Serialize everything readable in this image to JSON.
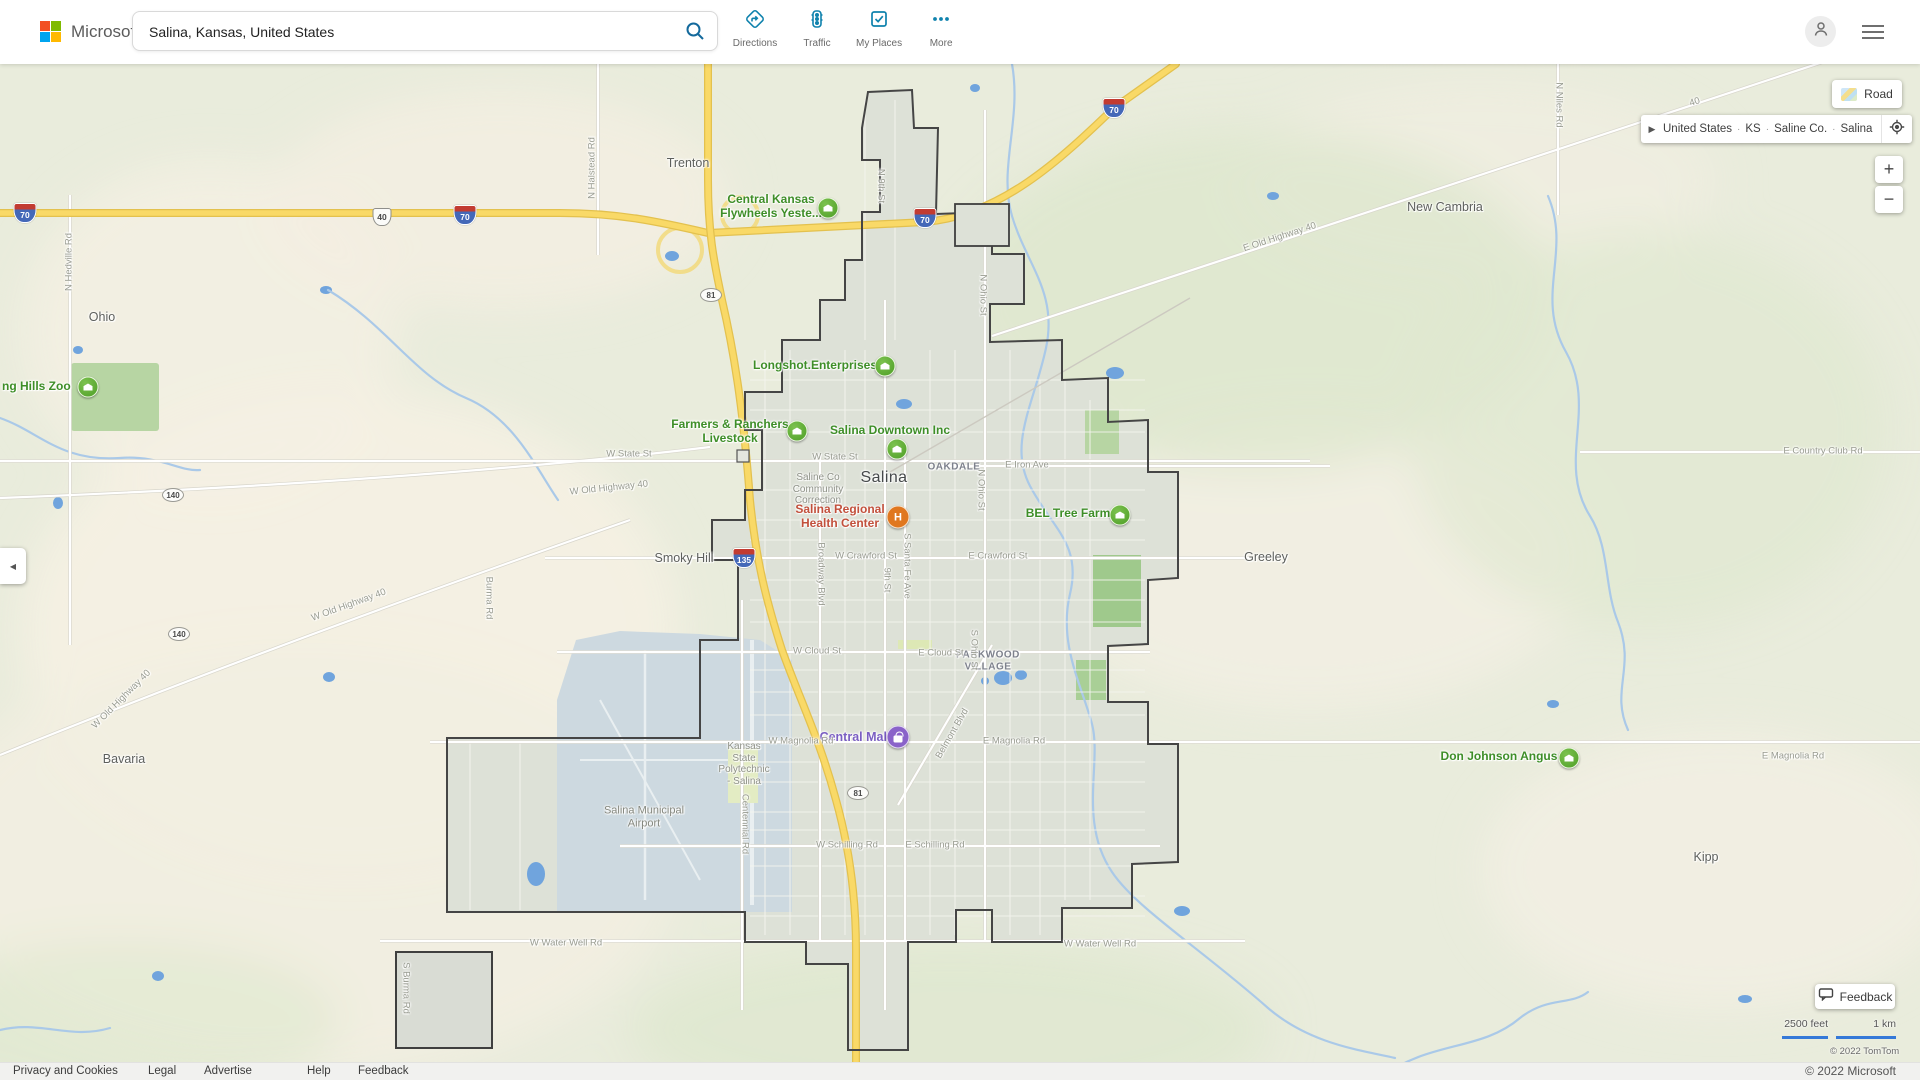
{
  "header": {
    "brand": "Microsoft Bing",
    "search": {
      "value": "Salina, Kansas, United States"
    },
    "toolbar": [
      {
        "label": "Directions",
        "icon": "directions-icon"
      },
      {
        "label": "Traffic",
        "icon": "traffic-icon"
      },
      {
        "label": "My Places",
        "icon": "my-places-icon"
      },
      {
        "label": "More",
        "icon": "more-icon"
      }
    ]
  },
  "map_controls": {
    "style_button": "Road",
    "breadcrumb": {
      "parts": [
        "United States",
        "KS",
        "Saline Co.",
        "Salina"
      ]
    },
    "zoom_in": "+",
    "zoom_out": "−",
    "feedback_button": "Feedback",
    "scale": {
      "imperial": "2500 feet",
      "metric": "1 km"
    },
    "map_copyright": "© 2022 TomTom"
  },
  "footer": {
    "links": [
      "Privacy and Cookies",
      "Legal",
      "Advertise",
      "Help",
      "Feedback"
    ],
    "copyright": "© 2022 Microsoft"
  },
  "colors": {
    "accent_teal": "#0f82ad",
    "poi_green": "#3e8e28",
    "poi_red": "#c2503c",
    "poi_purple": "#7a5ec2",
    "highway_yellow": "#f9d967",
    "water_blue": "#70a4dd"
  },
  "map": {
    "labels": [
      {
        "text": "Trenton",
        "x": 688,
        "y": 163,
        "cls": "city"
      },
      {
        "text": "Ohio",
        "x": 102,
        "y": 317,
        "cls": "city"
      },
      {
        "text": "New Cambria",
        "x": 1445,
        "y": 207,
        "cls": "city"
      },
      {
        "text": "Smoky Hill",
        "x": 684,
        "y": 558,
        "cls": "city"
      },
      {
        "text": "Greeley",
        "x": 1266,
        "y": 557,
        "cls": "city"
      },
      {
        "text": "Bavaria",
        "x": 124,
        "y": 759,
        "cls": "city"
      },
      {
        "text": "Kipp",
        "x": 1706,
        "y": 857,
        "cls": "city"
      },
      {
        "text": "Salina",
        "x": 884,
        "y": 478,
        "cls": "city-major"
      },
      {
        "text": "OAKDALE",
        "x": 954,
        "y": 467,
        "cls": "nbhd"
      },
      {
        "text": "PARKWOOD\nVILLAGE",
        "x": 988,
        "y": 661,
        "cls": "nbhd"
      },
      {
        "text": "Saline Co\nCommunity\nCorrection",
        "x": 818,
        "y": 489,
        "cls": "small"
      },
      {
        "text": "Kansas\nState\nPolytechnic\n- Salina",
        "x": 744,
        "y": 764,
        "cls": "small"
      },
      {
        "text": "Salina Municipal\nAirport",
        "x": 644,
        "y": 817,
        "cls": "area"
      },
      {
        "text": "Central Kansas\nFlywheels Yeste...",
        "x": 771,
        "y": 207,
        "cls": "poi-green"
      },
      {
        "text": "Longshot.Enterprises",
        "x": 815,
        "y": 366,
        "cls": "poi-green"
      },
      {
        "text": "Farmers & Ranchers\nLivestock",
        "x": 730,
        "y": 432,
        "cls": "poi-green"
      },
      {
        "text": "Salina Downtown Inc",
        "x": 890,
        "y": 431,
        "cls": "poi-green"
      },
      {
        "text": "BEL Tree Farm",
        "x": 1068,
        "y": 514,
        "cls": "poi-green"
      },
      {
        "text": "Don Johnson Angus",
        "x": 1499,
        "y": 757,
        "cls": "poi-green"
      },
      {
        "text": "ng Hills Zoo",
        "x": 2,
        "y": 387,
        "cls": "poi-green",
        "anchor": "left"
      },
      {
        "text": "Salina Regional\nHealth Center",
        "x": 840,
        "y": 517,
        "cls": "poi-red"
      },
      {
        "text": "Central Mall",
        "x": 855,
        "y": 737,
        "cls": "poi-purple"
      },
      {
        "text": "W State St",
        "x": 629,
        "y": 455,
        "cls": "road"
      },
      {
        "text": "W State St",
        "x": 835,
        "y": 458,
        "cls": "road"
      },
      {
        "text": "E Iron Ave",
        "x": 1027,
        "y": 466,
        "cls": "road"
      },
      {
        "text": "W Crawford St",
        "x": 866,
        "y": 557,
        "cls": "road"
      },
      {
        "text": "E Crawford St",
        "x": 998,
        "y": 557,
        "cls": "road"
      },
      {
        "text": "W Cloud St",
        "x": 817,
        "y": 652,
        "cls": "road"
      },
      {
        "text": "E Cloud St",
        "x": 941,
        "y": 654,
        "cls": "road"
      },
      {
        "text": "W Magnolia Rd",
        "x": 801,
        "y": 742,
        "cls": "road"
      },
      {
        "text": "E Magnolia Rd",
        "x": 1014,
        "y": 742,
        "cls": "road"
      },
      {
        "text": "E Magnolia Rd",
        "x": 1793,
        "y": 757,
        "cls": "road"
      },
      {
        "text": "W Schilling Rd",
        "x": 847,
        "y": 846,
        "cls": "road"
      },
      {
        "text": "E Schilling Rd",
        "x": 935,
        "y": 846,
        "cls": "road"
      },
      {
        "text": "W Water Well Rd",
        "x": 566,
        "y": 944,
        "cls": "road"
      },
      {
        "text": "W Water Well Rd",
        "x": 1100,
        "y": 945,
        "cls": "road"
      },
      {
        "text": "E Country Club Rd",
        "x": 1823,
        "y": 452,
        "cls": "road"
      },
      {
        "text": "W Old Highway 40",
        "x": 609,
        "y": 489,
        "cls": "road",
        "rot": -6
      },
      {
        "text": "W Old Highway 40",
        "x": 349,
        "y": 606,
        "cls": "road",
        "rot": -20
      },
      {
        "text": "W Old Highway 40",
        "x": 122,
        "y": 700,
        "cls": "road",
        "rot": -45
      },
      {
        "text": "E Old Highway 40",
        "x": 1280,
        "y": 238,
        "cls": "road",
        "rot": -18
      },
      {
        "text": "40",
        "x": 1695,
        "y": 103,
        "cls": "road",
        "rot": -18
      },
      {
        "text": "N Halstead Rd",
        "x": 593,
        "y": 168,
        "cls": "road",
        "rot": -90
      },
      {
        "text": "N Hedville Rd",
        "x": 70,
        "y": 262,
        "cls": "road",
        "rot": -90
      },
      {
        "text": "N 9th St",
        "x": 880,
        "y": 186,
        "cls": "road",
        "rot": 90
      },
      {
        "text": "N Ohio St",
        "x": 982,
        "y": 295,
        "cls": "road",
        "rot": 90
      },
      {
        "text": "N Ohio St",
        "x": 980,
        "y": 490,
        "cls": "road",
        "rot": 90
      },
      {
        "text": "S Ohio St",
        "x": 973,
        "y": 650,
        "cls": "road",
        "rot": 90
      },
      {
        "text": "S Santa Fe Ave",
        "x": 906,
        "y": 566,
        "cls": "road",
        "rot": 90
      },
      {
        "text": "9th St",
        "x": 886,
        "y": 580,
        "cls": "road",
        "rot": 90
      },
      {
        "text": "Broadway Blvd",
        "x": 820,
        "y": 574,
        "cls": "road",
        "rot": 90
      },
      {
        "text": "Centennial Rd",
        "x": 744,
        "y": 824,
        "cls": "road",
        "rot": 90
      },
      {
        "text": "Belmont Blvd",
        "x": 953,
        "y": 734,
        "cls": "road",
        "rot": -60
      },
      {
        "text": "S Burma Rd",
        "x": 405,
        "y": 988,
        "cls": "road",
        "rot": 90
      },
      {
        "text": "Burma Rd",
        "x": 488,
        "y": 598,
        "cls": "road",
        "rot": 90
      },
      {
        "text": "N Niles Rd",
        "x": 1558,
        "y": 105,
        "cls": "road",
        "rot": 90
      }
    ],
    "markers": [
      {
        "x": 88,
        "y": 387,
        "type": "green",
        "name": "zoo-poi-marker"
      },
      {
        "x": 828,
        "y": 208,
        "type": "green",
        "name": "flywheels-poi-marker"
      },
      {
        "x": 885,
        "y": 366,
        "type": "green",
        "name": "longshot-poi-marker"
      },
      {
        "x": 797,
        "y": 431,
        "type": "green",
        "name": "farmers-ranchers-poi-marker"
      },
      {
        "x": 897,
        "y": 449,
        "type": "green",
        "name": "salina-downtown-poi-marker"
      },
      {
        "x": 1120,
        "y": 515,
        "type": "green",
        "name": "bel-tree-farm-poi-marker"
      },
      {
        "x": 1569,
        "y": 758,
        "type": "green",
        "name": "don-johnson-poi-marker"
      },
      {
        "x": 898,
        "y": 517,
        "type": "hospital",
        "glyph": "H",
        "name": "hospital-marker"
      },
      {
        "x": 898,
        "y": 737,
        "type": "mall",
        "name": "central-mall-marker"
      }
    ],
    "shields": [
      {
        "x": 25,
        "y": 213,
        "kind": "interstate",
        "num": "70"
      },
      {
        "x": 465,
        "y": 215,
        "kind": "interstate",
        "num": "70"
      },
      {
        "x": 925,
        "y": 218,
        "kind": "interstate",
        "num": "70"
      },
      {
        "x": 1114,
        "y": 108,
        "kind": "interstate",
        "num": "70"
      },
      {
        "x": 744,
        "y": 558,
        "kind": "interstate",
        "num": "135"
      },
      {
        "x": 382,
        "y": 217,
        "kind": "us",
        "num": "40"
      },
      {
        "x": 711,
        "y": 295,
        "kind": "oval",
        "num": "81"
      },
      {
        "x": 858,
        "y": 793,
        "kind": "oval",
        "num": "81"
      },
      {
        "x": 173,
        "y": 495,
        "kind": "oval",
        "num": "140"
      },
      {
        "x": 179,
        "y": 634,
        "kind": "oval",
        "num": "140"
      }
    ]
  }
}
